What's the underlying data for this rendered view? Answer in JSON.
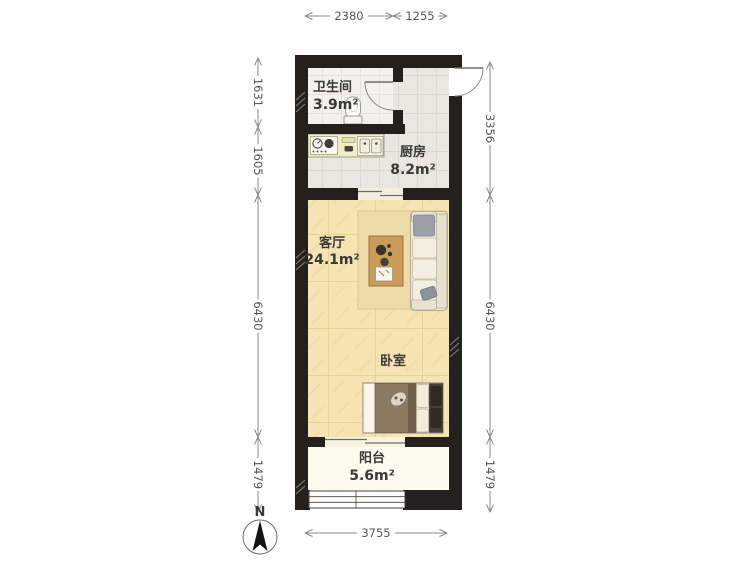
{
  "colors": {
    "wall": "#23201d",
    "kitchen_floor": "#e9e7e2",
    "bathroom_floor": "#f2f1ed",
    "living_floor": "#f6e3b2",
    "balcony_floor": "#fdfbee",
    "rug": "#eddcaa",
    "counter": "#f2edc9",
    "dimension_line": "#8a8a8a",
    "dimension_text": "#555555",
    "label_text": "#3a3a3a"
  },
  "rooms": {
    "bathroom": {
      "name": "卫生间",
      "area": "3.9m²"
    },
    "kitchen": {
      "name": "厨房",
      "area": "8.2m²"
    },
    "living": {
      "name": "客厅",
      "area": "24.1m²"
    },
    "bedroom": {
      "name": "卧室"
    },
    "balcony": {
      "name": "阳台",
      "area": "5.6m²"
    }
  },
  "dimensions": {
    "top": [
      {
        "label": "2380"
      },
      {
        "label": "1255"
      }
    ],
    "left": [
      {
        "label": "1631"
      },
      {
        "label": "1605"
      },
      {
        "label": "6430"
      },
      {
        "label": "1479"
      }
    ],
    "right": [
      {
        "label": "3356"
      },
      {
        "label": "6430"
      },
      {
        "label": "1479"
      }
    ],
    "bottom": [
      {
        "label": "3755"
      }
    ]
  },
  "compass": {
    "label": "N"
  }
}
